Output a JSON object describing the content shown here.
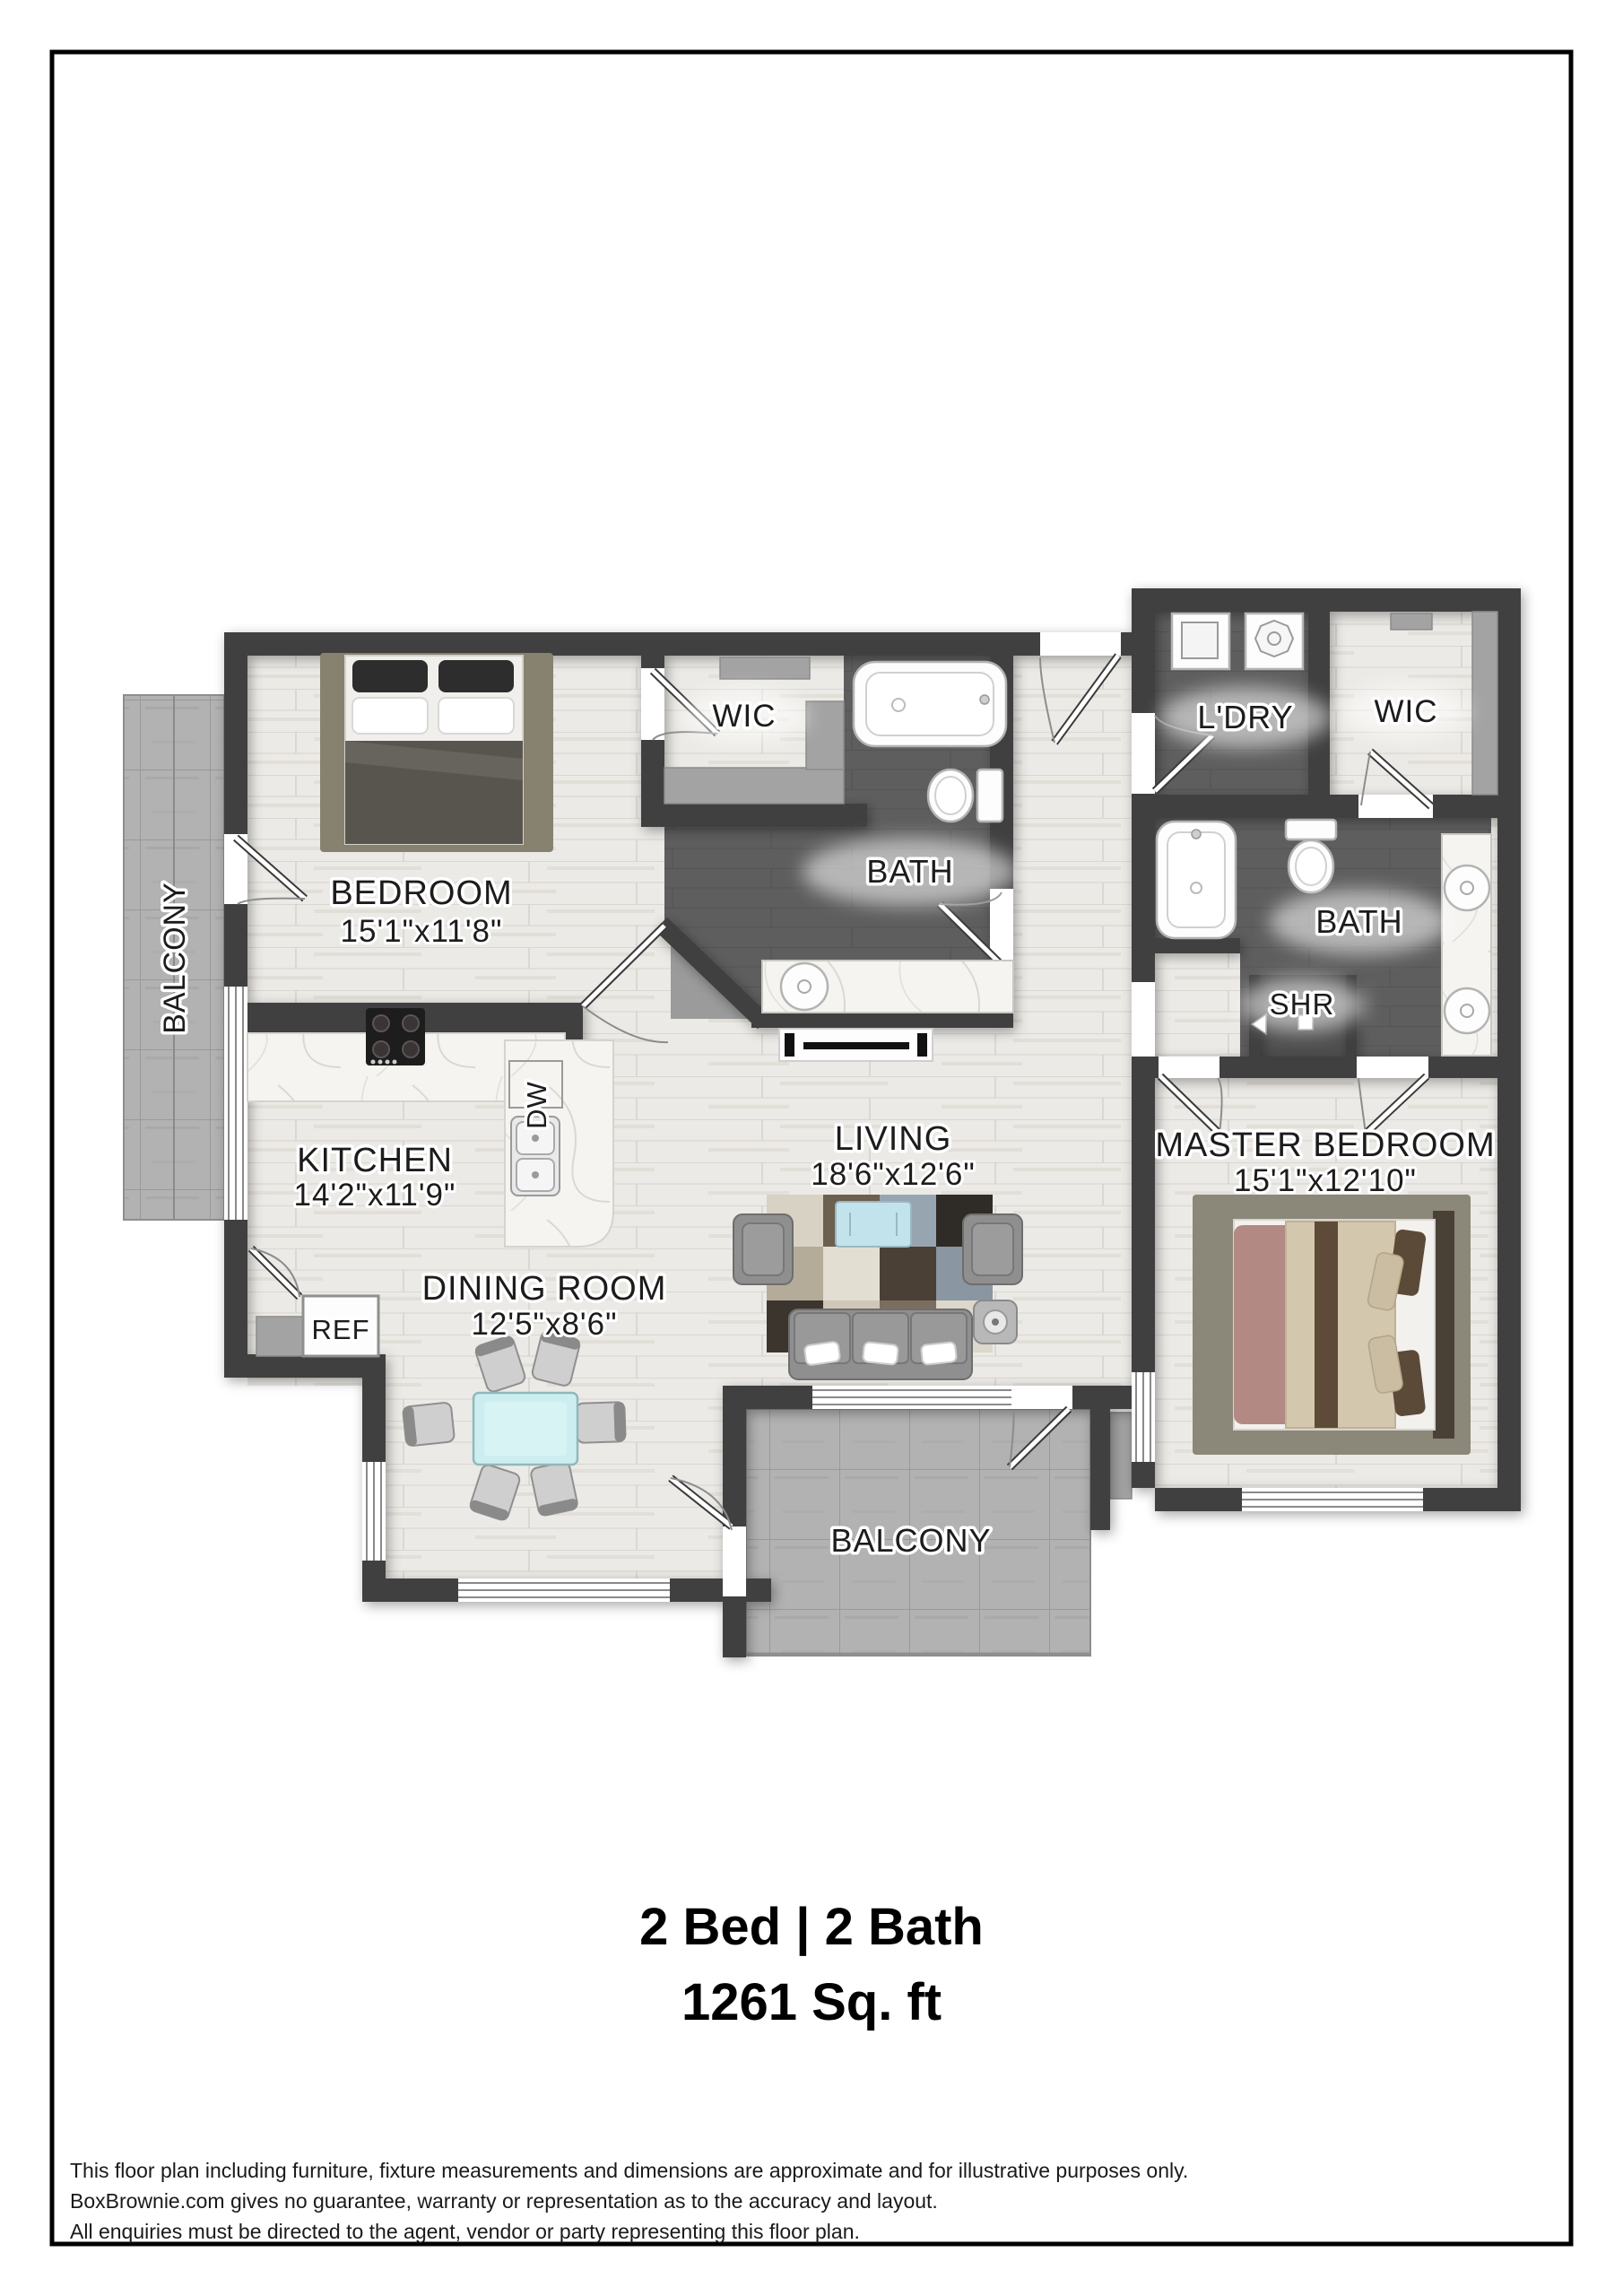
{
  "plan": {
    "rooms": {
      "bedroom": {
        "name": "BEDROOM",
        "dims": "15'1\"x11'8\""
      },
      "kitchen": {
        "name": "KITCHEN",
        "dims": "14'2\"x11'9\""
      },
      "dining": {
        "name": "DINING ROOM",
        "dims": "12'5\"x8'6\""
      },
      "living": {
        "name": "LIVING",
        "dims": "18'6\"x12'6\""
      },
      "master": {
        "name": "MASTER BEDROOM",
        "dims": "15'1\"x12'10\""
      },
      "bath_main": {
        "name": "BATH"
      },
      "bath_master": {
        "name": "BATH"
      },
      "wic_main": {
        "name": "WIC"
      },
      "wic_master": {
        "name": "WIC"
      },
      "laundry": {
        "name": "L'DRY"
      },
      "shower": {
        "name": "SHR"
      },
      "balcony_left": {
        "name": "BALCONY"
      },
      "balcony_bottom": {
        "name": "BALCONY"
      },
      "fridge": {
        "name": "REF"
      },
      "dishwasher": {
        "name": "DW"
      }
    },
    "summary": {
      "line1": "2 Bed | 2 Bath",
      "line2": "1261 Sq. ft"
    },
    "footer": {
      "lines": [
        "This floor plan including furniture, fixture measurements and dimensions are approximate and for illustrative purposes only.",
        "BoxBrownie.com gives no guarantee, warranty or representation as to the accuracy and layout.",
        "All enquiries must be directed to the agent, vendor or party representing this floor plan."
      ]
    },
    "colors": {
      "wall": "#3f3f3f",
      "wood_floor": "#ecebe7",
      "bath_floor": "#5e5e5e",
      "balcony_tile": "#b2b2b2",
      "marble": "#f5f4f1",
      "text": "#1c1c1c"
    }
  }
}
